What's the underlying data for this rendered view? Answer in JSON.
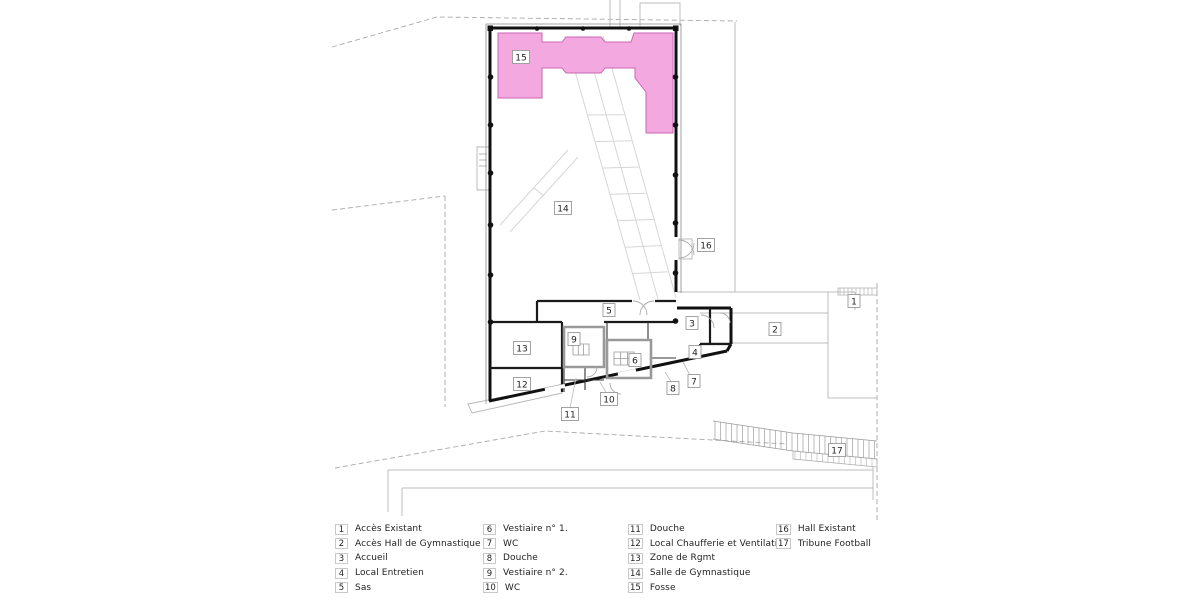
{
  "colors": {
    "fosse_fill": "#f4a8e0",
    "fosse_stroke": "#c967b6",
    "wall": "#111111",
    "context_line": "#bbbbbb"
  },
  "plan": {
    "area_labels": [
      {
        "n": "1",
        "x": 854,
        "y": 301
      },
      {
        "n": "2",
        "x": 775,
        "y": 329
      },
      {
        "n": "3",
        "x": 692,
        "y": 323
      },
      {
        "n": "4",
        "x": 695,
        "y": 352
      },
      {
        "n": "5",
        "x": 609,
        "y": 310
      },
      {
        "n": "6",
        "x": 635,
        "y": 360
      },
      {
        "n": "7",
        "x": 694,
        "y": 381
      },
      {
        "n": "8",
        "x": 673,
        "y": 388
      },
      {
        "n": "9",
        "x": 574,
        "y": 339
      },
      {
        "n": "10",
        "x": 609,
        "y": 399
      },
      {
        "n": "11",
        "x": 570,
        "y": 414
      },
      {
        "n": "12",
        "x": 522,
        "y": 384
      },
      {
        "n": "13",
        "x": 522,
        "y": 348
      },
      {
        "n": "14",
        "x": 563,
        "y": 208
      },
      {
        "n": "15",
        "x": 521,
        "y": 57
      },
      {
        "n": "16",
        "x": 706,
        "y": 245
      },
      {
        "n": "17",
        "x": 837,
        "y": 450
      }
    ]
  },
  "legend": {
    "columns": [
      {
        "items": [
          {
            "n": "1",
            "label": "Accès Existant"
          },
          {
            "n": "2",
            "label": "Accès Hall de Gymnastique"
          },
          {
            "n": "3",
            "label": "Accueil"
          },
          {
            "n": "4",
            "label": "Local Entretien"
          },
          {
            "n": "5",
            "label": "Sas"
          }
        ]
      },
      {
        "items": [
          {
            "n": "6",
            "label": "Vestiaire n° 1."
          },
          {
            "n": "7",
            "label": "WC"
          },
          {
            "n": "8",
            "label": "Douche"
          },
          {
            "n": "9",
            "label": "Vestiaire n° 2."
          },
          {
            "n": "10",
            "label": "WC"
          }
        ]
      },
      {
        "items": [
          {
            "n": "11",
            "label": "Douche"
          },
          {
            "n": "12",
            "label": "Local Chaufferie et Ventilation"
          },
          {
            "n": "13",
            "label": "Zone de Rgmt"
          },
          {
            "n": "14",
            "label": "Salle de Gymnastique"
          },
          {
            "n": "15",
            "label": "Fosse"
          }
        ]
      },
      {
        "items": [
          {
            "n": "16",
            "label": "Hall Existant"
          },
          {
            "n": "17",
            "label": "Tribune Football"
          }
        ]
      }
    ]
  }
}
